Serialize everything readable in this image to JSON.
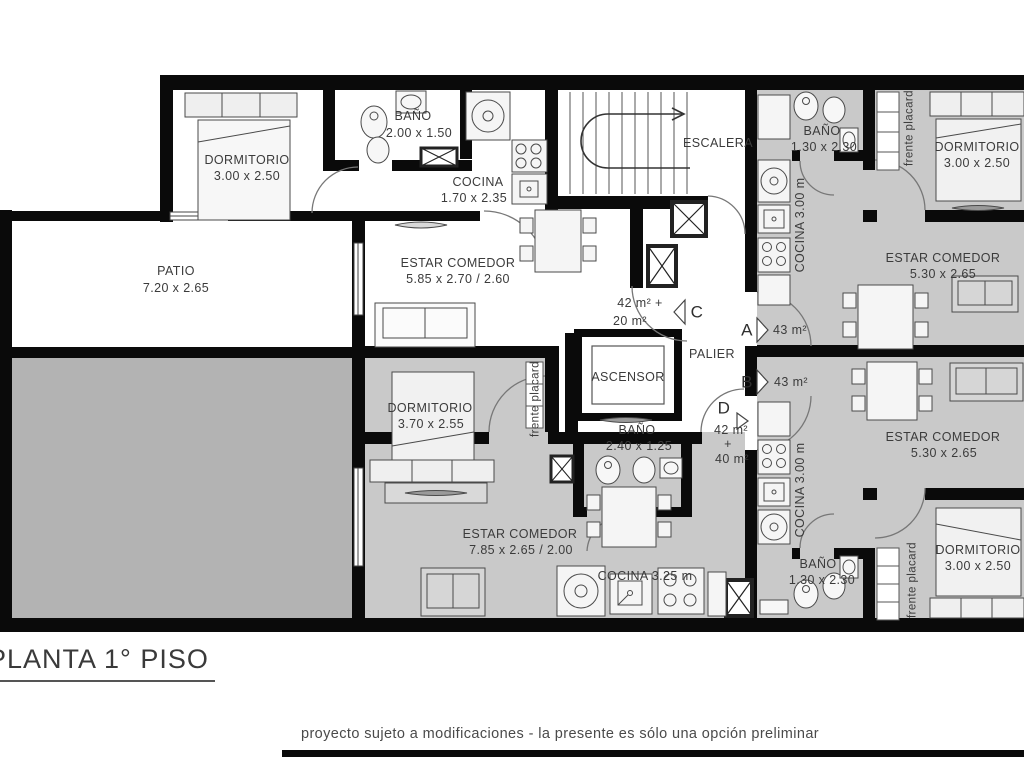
{
  "title": "PLANTA 1° PISO",
  "disclaimer": "proyecto sujeto a modificaciones - la presente es sólo una opción preliminar",
  "colors": {
    "wall": "#0a0a0a",
    "patio_floor": "#b3b3b3",
    "unit_floor": "#c9c9c9",
    "text": "#3b3b3b"
  },
  "units": [
    {
      "id": "A",
      "area": "43 m²"
    },
    {
      "id": "B",
      "area": "43 m²"
    },
    {
      "id": "C",
      "area": "42 m² + 20 m²"
    },
    {
      "id": "D",
      "area": "42 m² + 40 m²"
    }
  ],
  "labels": [
    {
      "t": "DORMITORIO"
    },
    {
      "t": "3.00 x 2.50"
    },
    {
      "t": "BAÑO"
    },
    {
      "t": "2.00 x 1.50"
    },
    {
      "t": "COCINA"
    },
    {
      "t": "1.70 x 2.35"
    },
    {
      "t": "ESCALERA"
    },
    {
      "t": "BAÑO"
    },
    {
      "t": "1.30 x 2.30"
    },
    {
      "t": "DORMITORIO"
    },
    {
      "t": "3.00 x 2.50"
    },
    {
      "t": "frente placard"
    },
    {
      "t": "COCINA 3.00 m"
    },
    {
      "t": "PATIO"
    },
    {
      "t": "7.20 x 2.65"
    },
    {
      "t": "ESTAR COMEDOR"
    },
    {
      "t": "5.85 x 2.70 / 2.60"
    },
    {
      "t": "ESTAR COMEDOR"
    },
    {
      "t": "5.30 x 2.65"
    },
    {
      "t": "42 m² +"
    },
    {
      "t": "20 m²"
    },
    {
      "t": "C"
    },
    {
      "t": "A"
    },
    {
      "t": "43 m²"
    },
    {
      "t": "B"
    },
    {
      "t": "43 m²"
    },
    {
      "t": "PALIER"
    },
    {
      "t": "ASCENSOR"
    },
    {
      "t": "DORMITORIO"
    },
    {
      "t": "3.70 x 2.55"
    },
    {
      "t": "frente placard"
    },
    {
      "t": "BAÑO"
    },
    {
      "t": "2.40 x 1.25"
    },
    {
      "t": "D"
    },
    {
      "t": "42 m²"
    },
    {
      "t": "+"
    },
    {
      "t": "40 m²"
    },
    {
      "t": "ESTAR COMEDOR"
    },
    {
      "t": "7.85 x 2.65 / 2.00"
    },
    {
      "t": "COCINA 3.25 m"
    },
    {
      "t": "ESTAR COMEDOR"
    },
    {
      "t": "5.30 x 2.65"
    },
    {
      "t": "COCINA 3.00 m"
    },
    {
      "t": "BAÑO"
    },
    {
      "t": "1.30 x 2.30"
    },
    {
      "t": "DORMITORIO"
    },
    {
      "t": "3.00 x 2.50"
    },
    {
      "t": "frente placard"
    }
  ]
}
